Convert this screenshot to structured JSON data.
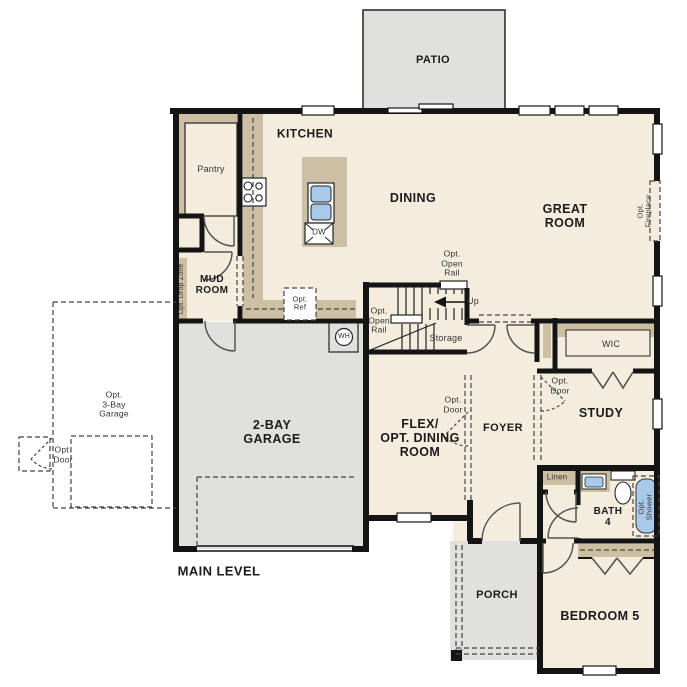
{
  "plan": {
    "title": "MAIN LEVEL",
    "rooms": {
      "patio": "PATIO",
      "kitchen": "KITCHEN",
      "pantry": "Pantry",
      "dining": "DINING",
      "great_room": "GREAT\nROOM",
      "mud_room": "MUD\nROOM",
      "garage": "2-BAY\nGARAGE",
      "flex": "FLEX/\nOPT. DINING\nROOM",
      "foyer": "FOYER",
      "study": "STUDY",
      "wic": "WIC",
      "storage": "Storage",
      "linen": "Linen",
      "bath4": "BATH\n4",
      "bedroom5": "BEDROOM 5",
      "porch": "PORCH"
    },
    "annotations": {
      "up": "Up",
      "dw": "DW",
      "wh": "WH",
      "opt_ref": "Opt.\nRef",
      "opt_open_rail_upper": "Opt.\nOpen\nRail",
      "opt_open_rail_lower": "Opt.\nOpen\nRail",
      "opt_drop_zone": "Opt. Drop Zone",
      "opt_fireplace": "Opt. Fireplace",
      "opt_shower": "Opt.\nShower",
      "opt_3bay_garage": "Opt.\n3-Bay\nGarage",
      "opt_door_3bay": "Opt.\nDoor",
      "opt_door_flex": "Opt.\nDoor",
      "opt_door_study": "Opt.\nDoor"
    },
    "colors": {
      "wall": "#141414",
      "floor": "#f4edde",
      "hardscape_gray": "#e0e0de",
      "casework_tan": "#cdbfa4",
      "fixture_blue": "#a9c9e9"
    }
  }
}
